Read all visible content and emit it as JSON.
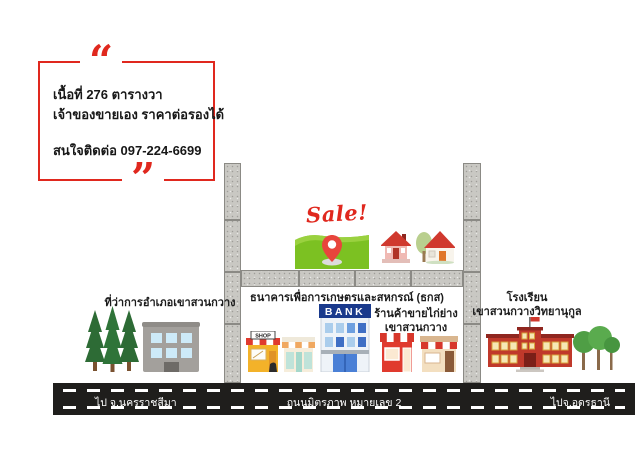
{
  "ad_box": {
    "open_quote": "“",
    "close_quote": "”",
    "area_line": "เนื้อที่ 276 ตารางวา",
    "owner_line": "เจ้าของขายเอง ราคาต่อรองได้",
    "contact_line": "สนใจติดต่อ 097-224-6699"
  },
  "sale_sign": {
    "label": "Sale!"
  },
  "landmarks": {
    "district_office": "ที่ว่าการอำเภอเขาสวนกวาง",
    "bank": "ธนาคารเพื่อการเกษตรและสหกรณ์ (ธกส)",
    "chicken_shop_line1": "ร้านค้าขายไก่ย่าง",
    "chicken_shop_line2": "เขาสวนกวาง",
    "school_line1": "โรงเรียน",
    "school_line2": "เขาสวนกวางวิทยานุกูล"
  },
  "buildings": {
    "bank_sign": "BANK",
    "shop_sign": "SHOP"
  },
  "road": {
    "left_label": "ไป จ.นครราชสีมา",
    "center_label": "ถนนมิตรภาพ หมายเลข 2",
    "right_label": "ไปจ.อุดรธานี"
  },
  "colors": {
    "accent_red": "#e0281e",
    "grass_green": "#7cc122",
    "road_black": "#1f1e1c",
    "concrete_gray": "#c9c8c3"
  }
}
